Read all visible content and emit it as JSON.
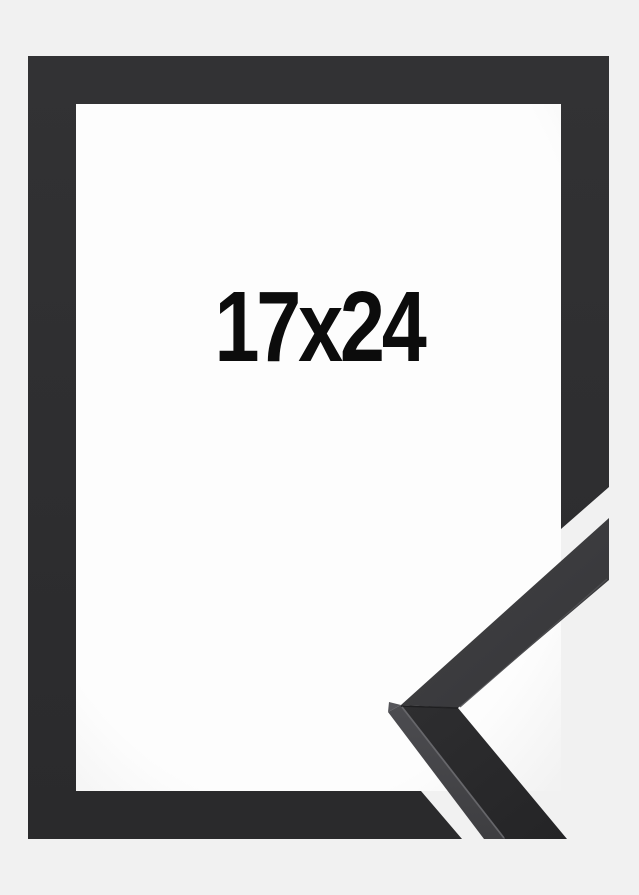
{
  "product": {
    "size_label": "17x24",
    "description": "black picture frame shown from the front with a close-up mitered corner sample of the moulding profile overlapping the bottom-right corner"
  },
  "graphics": {
    "frame_front": "black-picture-frame-front-graphic",
    "corner_sample": "frame-moulding-corner-sample-graphic"
  },
  "colors": {
    "background": "#f1f1f1",
    "inner_background": "#fdfdfd",
    "inner_background_edge": "#f2f2f2",
    "frame_top": "#323234",
    "frame_bottom": "#2a2a2c",
    "label_text": "#0c0c0c",
    "sample_upper_light": "#424245",
    "sample_upper_dark": "#353538",
    "sample_lower_light": "#2e2e30",
    "sample_lower_dark": "#242426",
    "sample_side_light": "#4c4c50",
    "sample_side_dark": "#3e3e41",
    "sample_tip_facet": "#55555a",
    "sample_edge_highlight": "#6a6a6e",
    "sample_inner_edge_line": "#4f4f52",
    "miter_seam": "#1c1c1e"
  }
}
